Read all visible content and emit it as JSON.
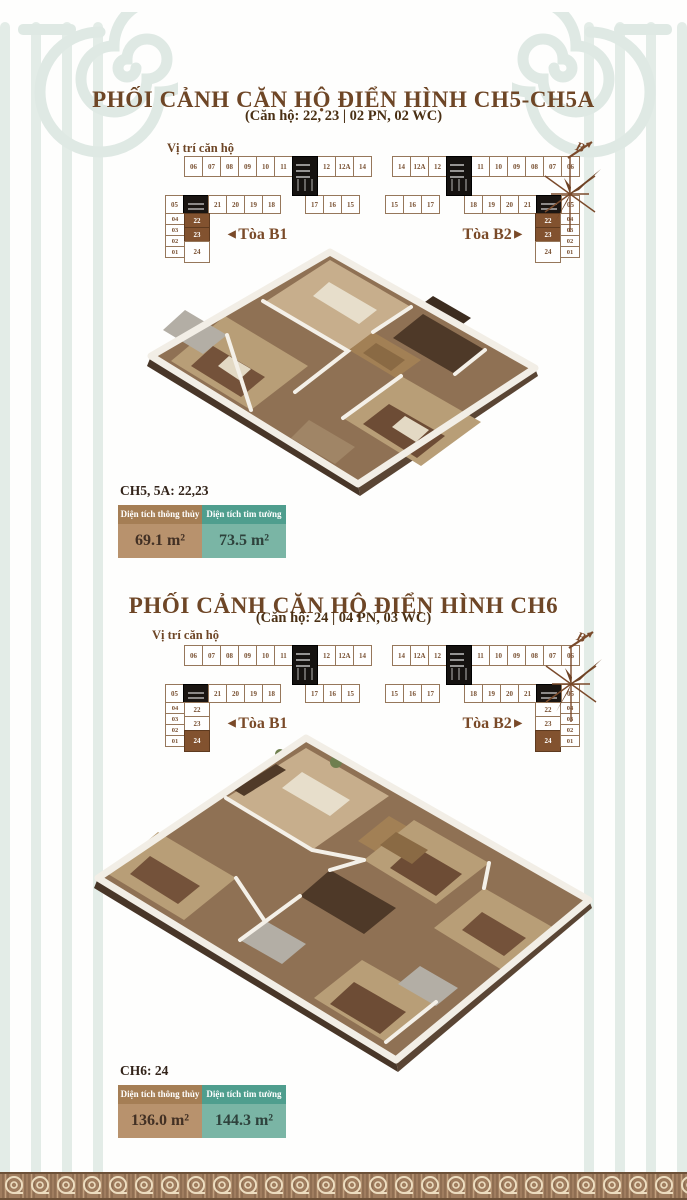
{
  "page": {
    "width": 687,
    "height": 1200
  },
  "palette": {
    "title_brown": "#6e4626",
    "subtitle_brown": "#4a3014",
    "highlight_unit": "#82522f",
    "net_header": "#a57e55",
    "net_body": "#b8926d",
    "gross_header": "#4f9e8e",
    "gross_body": "#7ab5a5",
    "ornament_sage": "#e3ece7",
    "frieze_brown": "#a07d5f"
  },
  "compass_label": "B",
  "floorplate": {
    "b1": {
      "row1a": [
        "06",
        "07",
        "08",
        "09",
        "10",
        "11"
      ],
      "row1b": [
        "12",
        "12A",
        "14"
      ],
      "row2_start": [
        "05"
      ],
      "row2a": [
        "21",
        "20",
        "19",
        "18"
      ],
      "row2b": [
        "17",
        "16",
        "15"
      ],
      "side_col": [
        "04",
        "03",
        "02",
        "01"
      ],
      "stack": [
        "22",
        "23",
        "24"
      ]
    },
    "b2": {
      "row1a": [
        "14",
        "12A",
        "12"
      ],
      "row1b": [
        "11",
        "10",
        "09",
        "08",
        "07",
        "06"
      ],
      "row2a": [
        "15",
        "16",
        "17"
      ],
      "row2b": [
        "18",
        "19",
        "20",
        "21"
      ],
      "row2_end": [
        "05"
      ],
      "side_col": [
        "04",
        "03",
        "02",
        "01"
      ],
      "stack": [
        "22",
        "23",
        "24"
      ]
    }
  },
  "sections": [
    {
      "title": "PHỐI CẢNH CĂN HỘ ĐIỂN HÌNH CH5-CH5A",
      "subtitle": "(Căn hộ: 22, 23 | 02 PN, 02 WC)",
      "location_label": "Vị trí căn hộ",
      "tower_b1_label": "Tòa B1",
      "tower_b2_label": "Tòa B2",
      "highlight_units": "22,23",
      "info": {
        "header": "CH5, 5A: 22,23",
        "net_area_label": "Diện tích thông thủy",
        "net_area_value": "69.1 m²",
        "gross_area_label": "Diện tích tim tường",
        "gross_area_value": "73.5 m²"
      }
    },
    {
      "title": "PHỐI CẢNH CĂN HỘ ĐIỂN HÌNH CH6",
      "subtitle": "(Căn hộ: 24 | 04 PN, 03 WC)",
      "location_label": "Vị trí căn hộ",
      "tower_b1_label": "Tòa B1",
      "tower_b2_label": "Tòa B2",
      "highlight_units": "24",
      "info": {
        "header": "CH6: 24",
        "net_area_label": "Diện tích thông thủy",
        "net_area_value": "136.0 m²",
        "gross_area_label": "Diện tích tim tường",
        "gross_area_value": "144.3 m²"
      }
    }
  ]
}
